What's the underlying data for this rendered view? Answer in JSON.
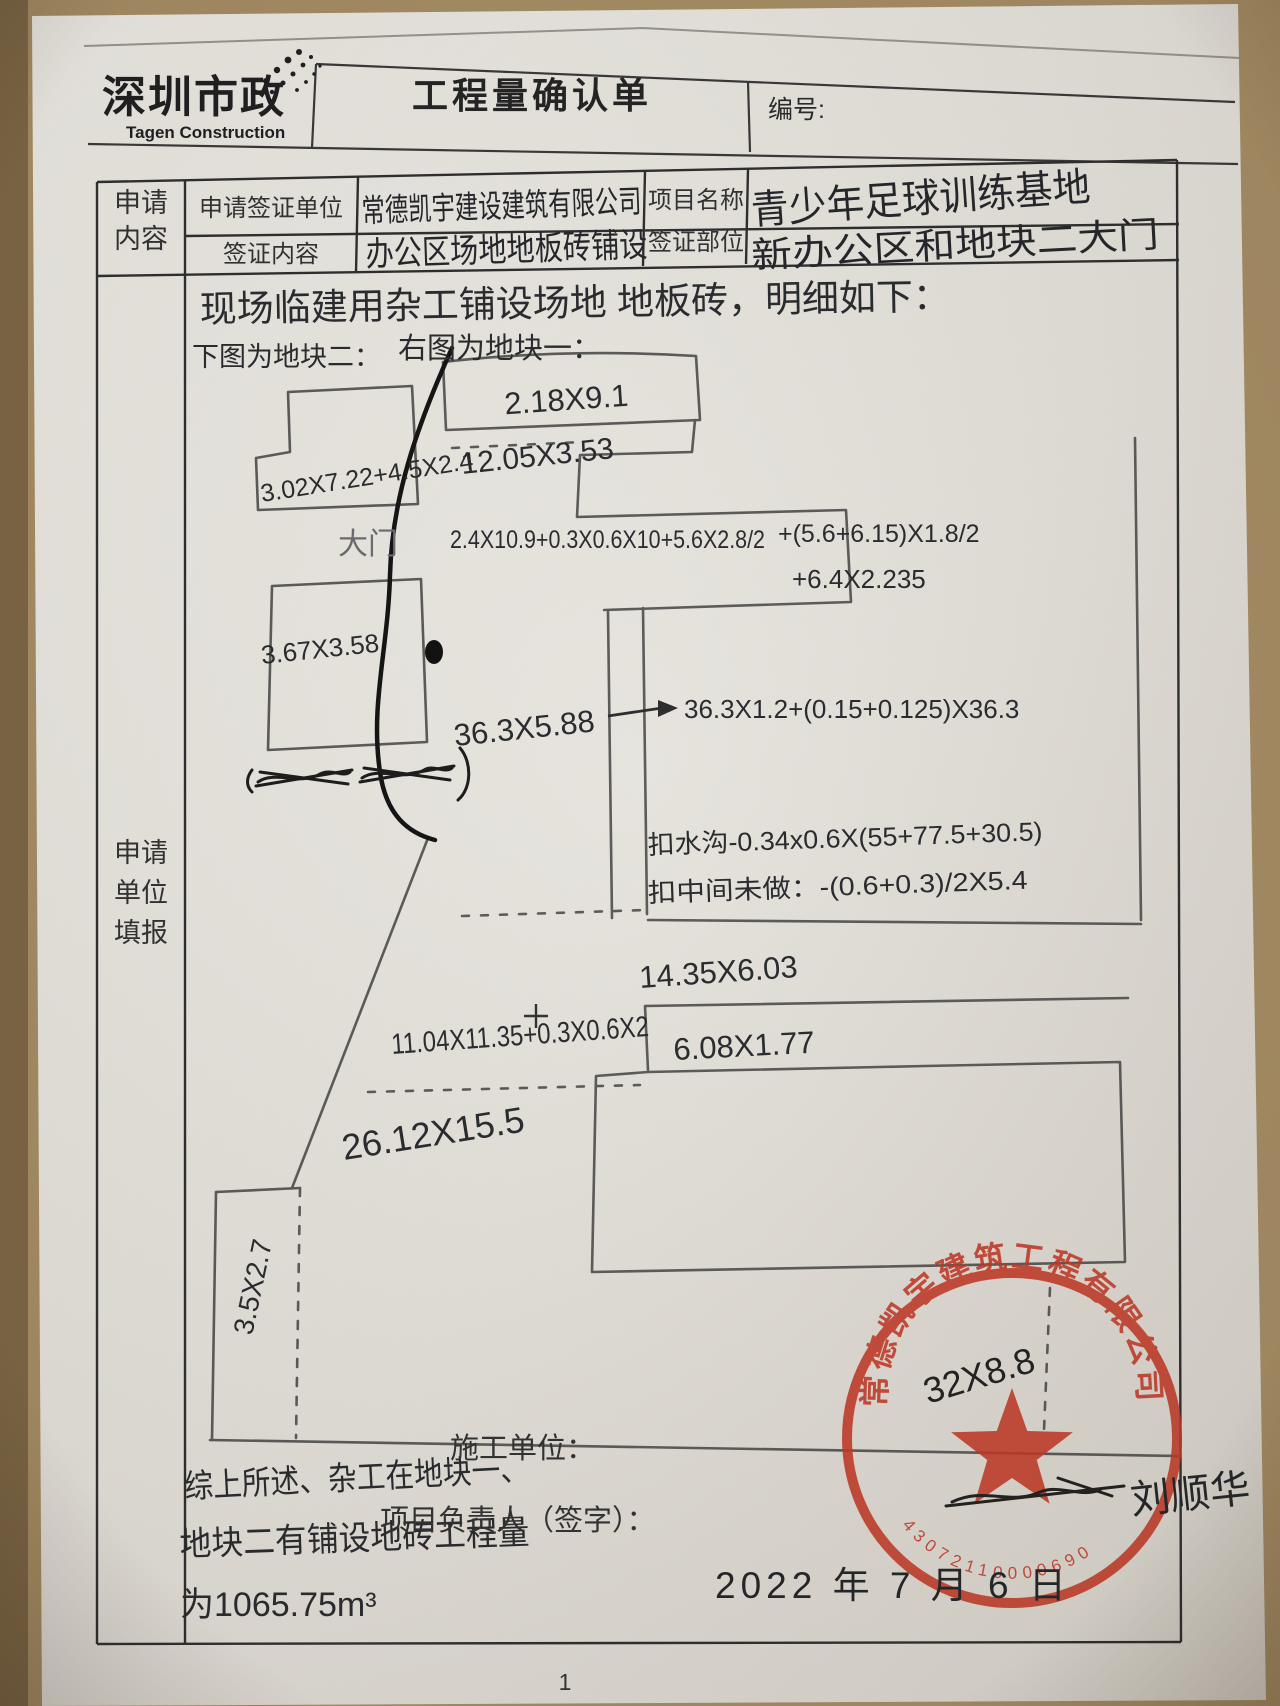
{
  "header": {
    "logo_cn": "深圳市政",
    "logo_en": "Tagen Construction",
    "title": "工程量确认单",
    "number_label": "编号:"
  },
  "form": {
    "section_label_line1": "申请",
    "section_label_line2": "内容",
    "filler_label_line1": "申请",
    "filler_label_line2": "单位",
    "filler_label_line3": "填报",
    "row1": {
      "label1": "申请签证单位",
      "value1": "常德凯宇建设建筑有限公司",
      "label2": "项目名称",
      "value2": "青少年足球训练基地"
    },
    "row2": {
      "label1": "签证内容",
      "value1": "办公区场地地板砖铺设",
      "label2": "签证部位",
      "value2": "新办公区和地块二大门"
    }
  },
  "sketch": {
    "intro": "现场临建用杂工铺设场地 地板砖，明细如下：",
    "caption_left": "下图为地块二：",
    "caption_right": "右图为地块一：",
    "gate_label": "大门",
    "measurements": {
      "top_rect": "2.18X9.1",
      "second": "12.05X3.53",
      "left_block": "3.02X7.22+4.5X2.4",
      "long_formula": "2.4X10.9+0.3X0.6X10+5.6X2.8/2",
      "long_formula2": "+(5.6+6.15)X1.8/2",
      "long_formula3": "+6.4X2.235",
      "left_rect": "3.67X3.58",
      "strip": "36.3X5.88",
      "arrow_formula": "36.3X1.2+(0.15+0.125)X36.3",
      "deduct_gutter": "扣水沟-0.34x0.6X(55+77.5+30.5)",
      "deduct_middle": "扣中间未做：-(0.6+0.3)/2X5.4",
      "mid_rect": "14.35X6.03",
      "mid_formula": "11.04X11.35+0.3X0.6X2",
      "lower_rect": "6.08X1.77",
      "big_area": "26.12X15.5",
      "left_strip": "3.5X2.7",
      "stamp_area": "32X8.8"
    },
    "summary_line1": "综上所述、杂工在地块一、",
    "summary_line2": "地块二有铺设地砖工程量",
    "summary_line3": "为1065.75m³"
  },
  "footer": {
    "contractor_label": "施工单位：",
    "manager_label": "项目负责人（签字）：",
    "signature": "刘顺华",
    "date": "2022 年 7 月 6 日",
    "page_number": "1"
  },
  "stamp": {
    "company": "常德凯宇建筑工程有限公司",
    "serial": "43072110000690",
    "color": "#c43a28"
  }
}
